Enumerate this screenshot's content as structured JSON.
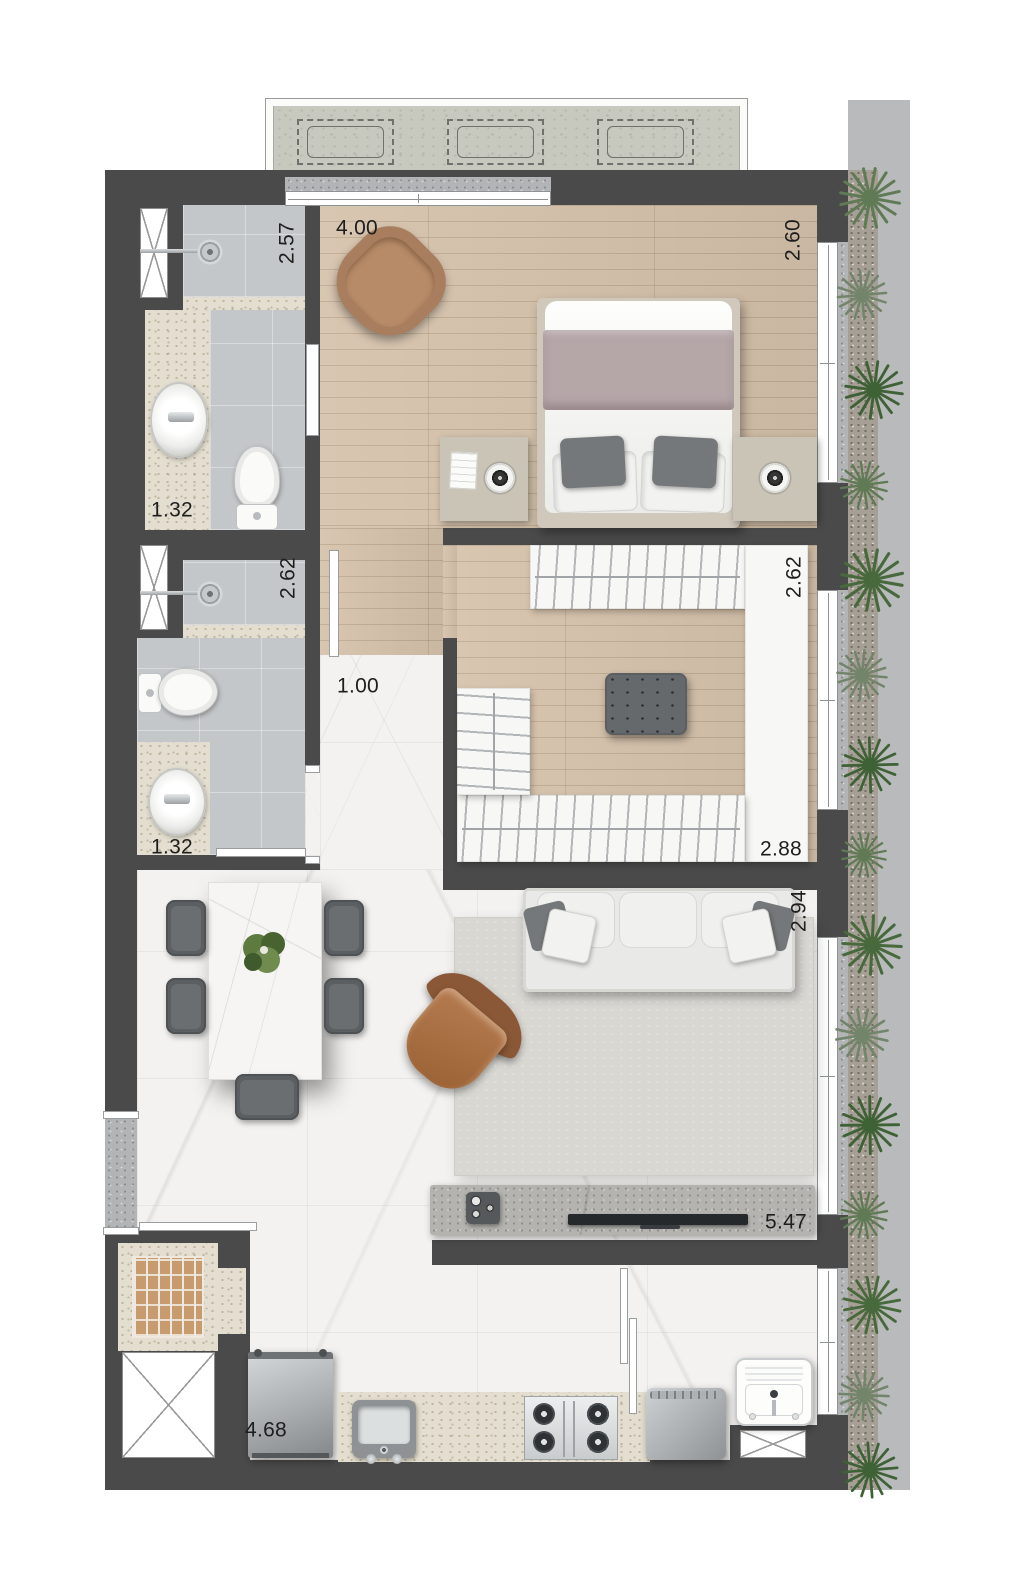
{
  "plan": {
    "type": "apartment-floor-plan-top-view",
    "dimensions": {
      "bath1_depth": "2.57",
      "bath1_width": "1.32",
      "bedroom_width": "4.00",
      "bedroom_depth": "2.60",
      "bath2_depth": "2.62",
      "bath2_width": "1.32",
      "hall_width": "1.00",
      "closet_depth": "2.62",
      "closet_width": "2.88",
      "living_depth": "2.94",
      "living_width": "5.47",
      "kitchen_width": "4.68"
    },
    "colors": {
      "wall": "#4a4a4a",
      "wood_floor": "#d5c1aa",
      "marble_floor": "#f3f2f0",
      "tile_floor": "#c4c7c9",
      "granite_counter": "#e3decf",
      "terrace_concrete": "#c7c9be",
      "walkway": "#b8babc",
      "plant_green": "#4c6b42",
      "bed_blanket": "#b5a6a8",
      "armchair_brown": "#a87e5f",
      "rug": "#d9d7d2"
    },
    "rooms": [
      "bedroom",
      "walk-in-closet",
      "bathroom-1",
      "bathroom-2",
      "hallway",
      "dining-area",
      "living-area",
      "kitchen",
      "laundry",
      "side-garden",
      "terrace-ac-slab"
    ],
    "furniture": [
      "armchair",
      "double-bed",
      "nightstands-with-lamps",
      "closet-racks",
      "ottoman",
      "dining-table",
      "dining-chairs",
      "plant-centerpiece",
      "sofa",
      "lounge-chair",
      "rug",
      "tv-console",
      "tv",
      "media-device",
      "refrigerator",
      "kitchen-sink",
      "cooktop",
      "washing-machine",
      "laundry-tub",
      "toilets",
      "showers",
      "vanity-sinks"
    ],
    "features": [
      "ac-condenser-units",
      "ventilation-shafts",
      "windows",
      "doors",
      "entry-landing",
      "brick-service-box",
      "garden-plants"
    ]
  }
}
